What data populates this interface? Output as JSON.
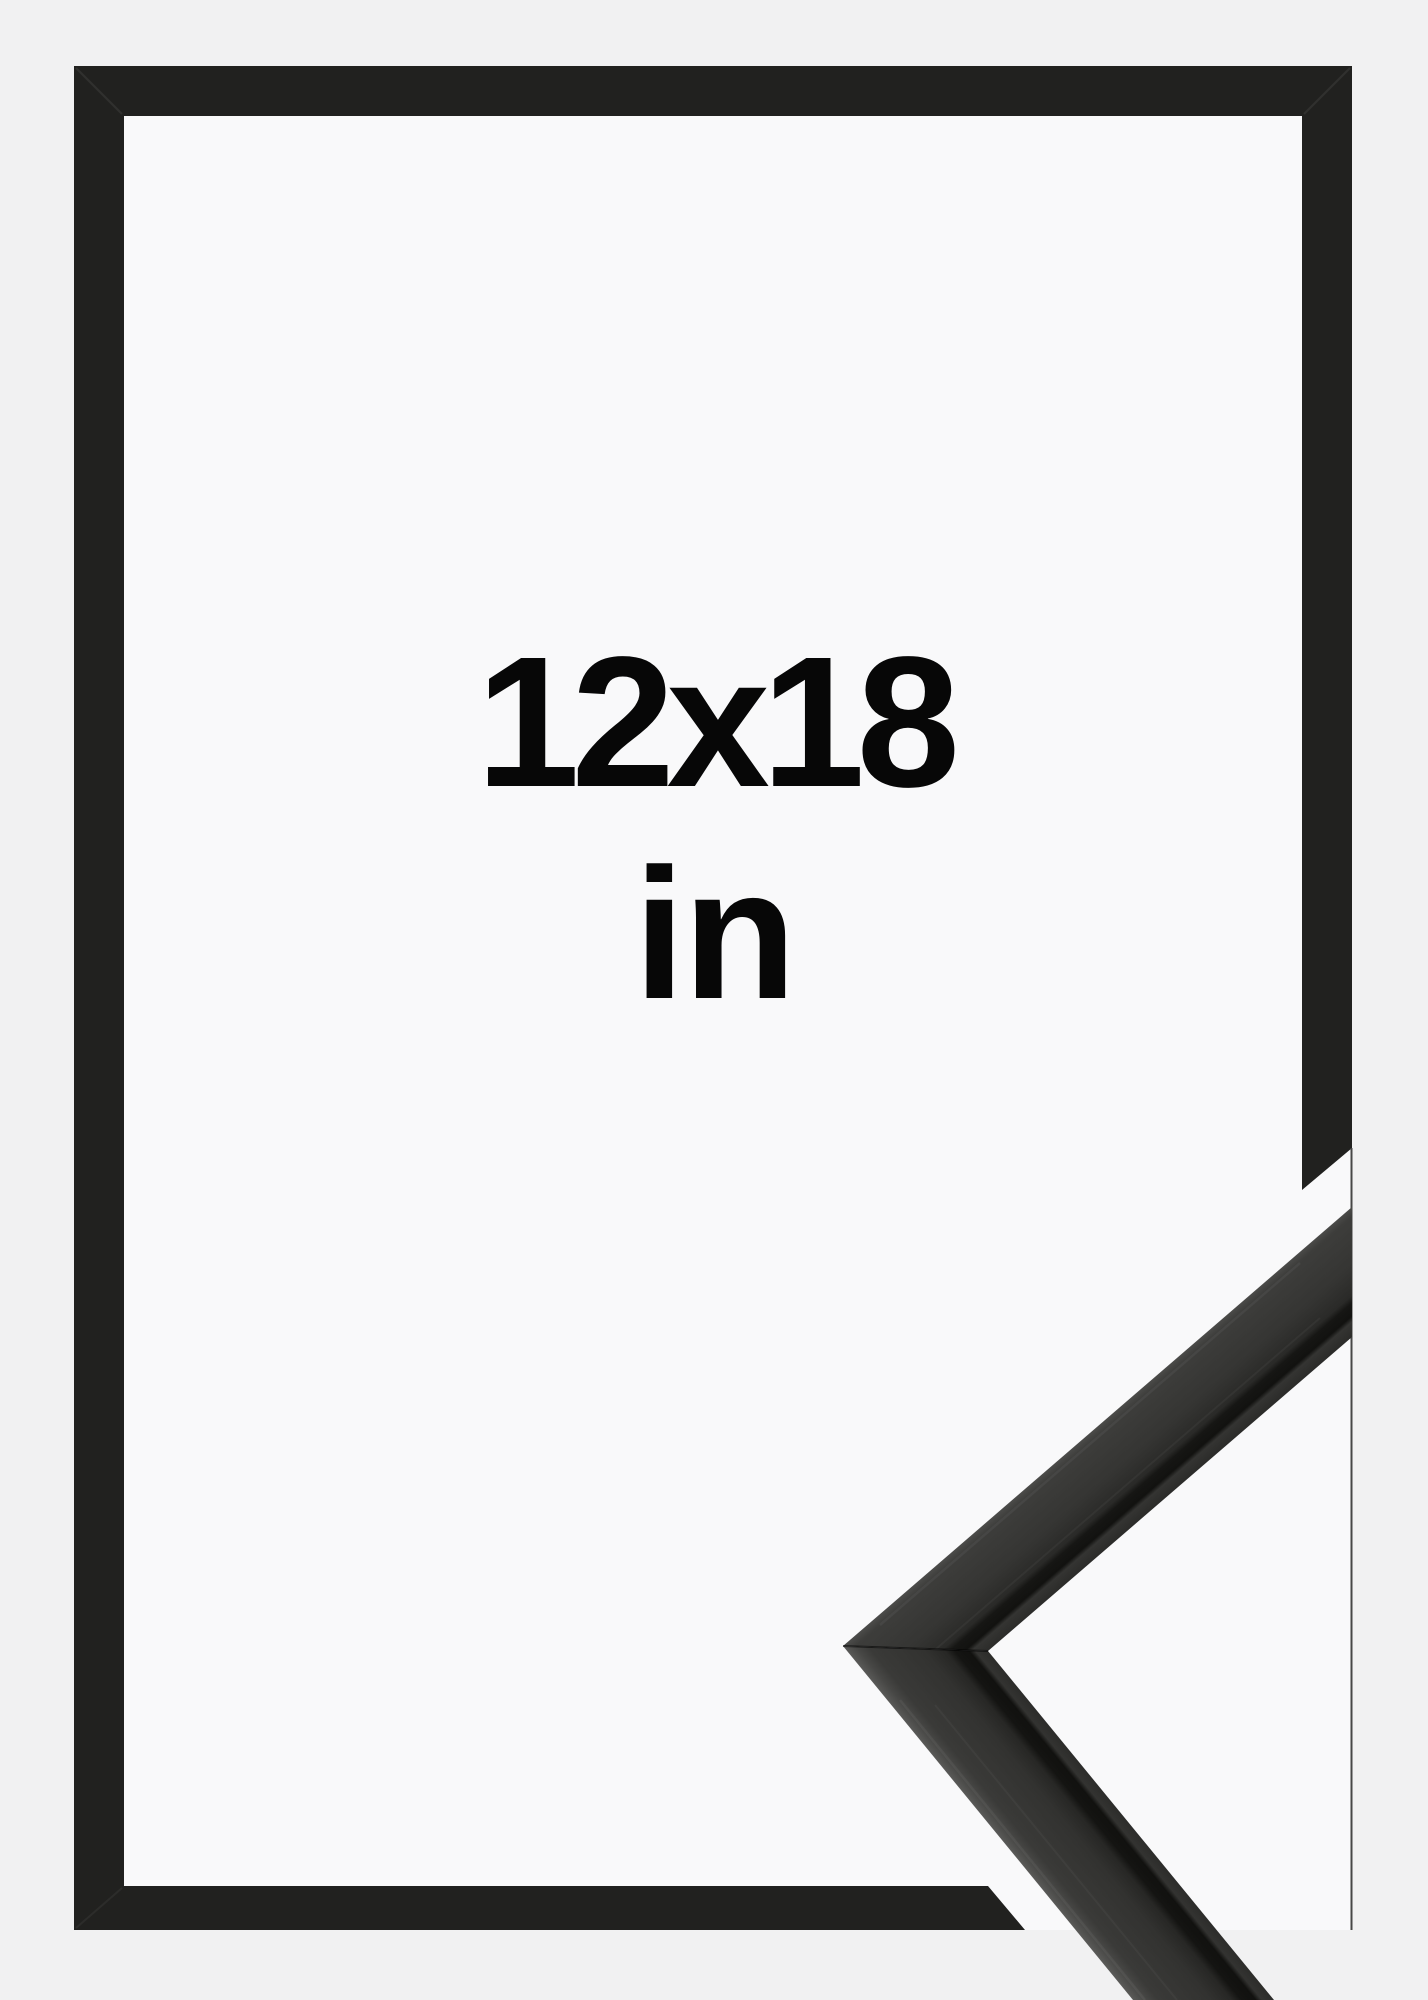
{
  "size_label": "12x18",
  "unit_label": "in",
  "colors": {
    "background": "#f1f1f2",
    "paper": "#f9f9fa",
    "frame_black": "#21211f",
    "hairline": "#474747",
    "sample_face": "#343432",
    "sample_edge": "#121210",
    "text": "#070707"
  }
}
